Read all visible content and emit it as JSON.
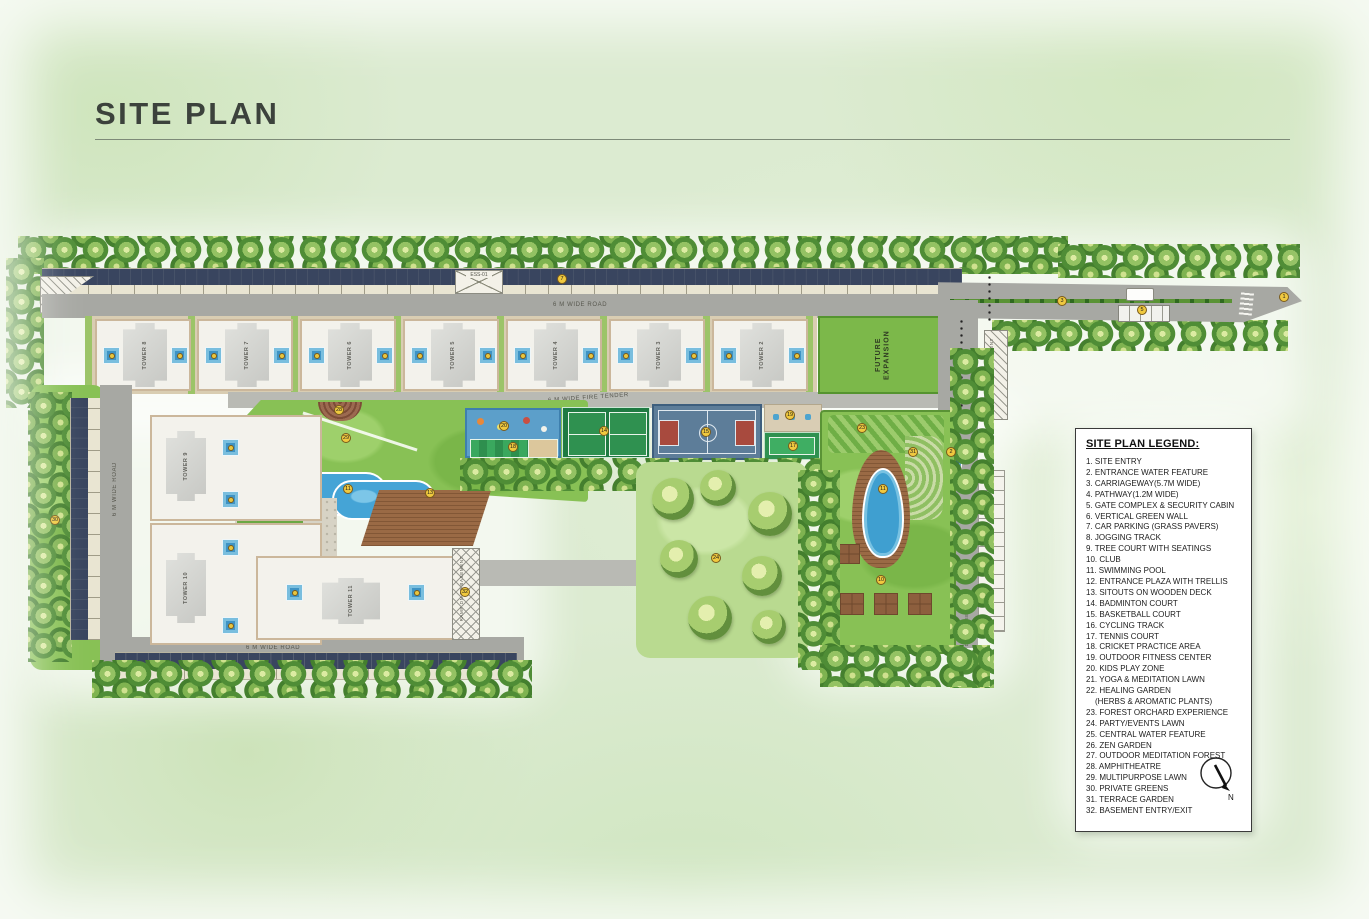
{
  "title": "SITE PLAN",
  "legend": {
    "title": "SITE PLAN LEGEND:",
    "items": [
      "1. SITE ENTRY",
      "2. ENTRANCE WATER FEATURE",
      "3. CARRIAGEWAY(5.7M WIDE)",
      "4. PATHWAY(1.2M WIDE)",
      "5. GATE COMPLEX & SECURITY CABIN",
      "6. VERTICAL GREEN WALL",
      "7. CAR PARKING (GRASS PAVERS)",
      "8. JOGGING TRACK",
      "9. TREE COURT WITH SEATINGS",
      "10. CLUB",
      "11. SWIMMING POOL",
      "12. ENTRANCE PLAZA WITH TRELLIS",
      "13. SITOUTS ON WOODEN DECK",
      "14. BADMINTON COURT",
      "15. BASKETBALL COURT",
      "16. CYCLING TRACK",
      "17. TENNIS COURT",
      "18. CRICKET PRACTICE AREA",
      "19. OUTDOOR FITNESS CENTER",
      "20. KIDS PLAY ZONE",
      "21. YOGA & MEDITATION LAWN",
      "22. HEALING GARDEN",
      "(HERBS & AROMATIC PLANTS)",
      "23. FOREST ORCHARD EXPERIENCE",
      "24. PARTY/EVENTS LAWN",
      "25. CENTRAL WATER FEATURE",
      "26. ZEN GARDEN",
      "27. OUTDOOR MEDITATION FOREST",
      "28. AMPHITHEATRE",
      "29. MULTIPURPOSE LAWN",
      "30. PRIVATE GREENS",
      "31. TERRACE GARDEN",
      "32. BASEMENT ENTRY/EXIT"
    ]
  },
  "plan": {
    "towers_top": [
      "TOWER 8",
      "TOWER 7",
      "TOWER 6",
      "TOWER 5",
      "TOWER 4",
      "TOWER 3",
      "TOWER 2"
    ],
    "towers_left": [
      "TOWER 9",
      "TOWER 10",
      "TOWER 11"
    ],
    "roads": {
      "top": "6 M WIDE ROAD",
      "fire": "6 M WIDE FIRE TENDER",
      "left": "6 M WIDE ROAD",
      "bottom": "6 M WIDE ROAD"
    },
    "future_expansion": "FUTURE EXPANSION",
    "ess": "ESS-01",
    "ramp_right": "RAMP DN TO BASEMENT",
    "ramp_tower11": "RAMP DN TO BASEMENT",
    "ramp_club": "RAMP DN TO BASEMENT",
    "north": "N",
    "markers": [
      {
        "n": "1",
        "x": 1284,
        "y": 297
      },
      {
        "n": "2",
        "x": 951,
        "y": 452
      },
      {
        "n": "3",
        "x": 1062,
        "y": 301
      },
      {
        "n": "5",
        "x": 1142,
        "y": 310
      },
      {
        "n": "7",
        "x": 562,
        "y": 279
      },
      {
        "n": "10",
        "x": 881,
        "y": 580
      },
      {
        "n": "11",
        "x": 348,
        "y": 489
      },
      {
        "n": "11",
        "x": 883,
        "y": 489
      },
      {
        "n": "13",
        "x": 430,
        "y": 493
      },
      {
        "n": "14",
        "x": 604,
        "y": 431
      },
      {
        "n": "15",
        "x": 706,
        "y": 432
      },
      {
        "n": "17",
        "x": 793,
        "y": 446
      },
      {
        "n": "18",
        "x": 513,
        "y": 447
      },
      {
        "n": "19",
        "x": 790,
        "y": 415
      },
      {
        "n": "20",
        "x": 504,
        "y": 426
      },
      {
        "n": "23",
        "x": 862,
        "y": 428
      },
      {
        "n": "24",
        "x": 716,
        "y": 558
      },
      {
        "n": "28",
        "x": 339,
        "y": 410
      },
      {
        "n": "29",
        "x": 346,
        "y": 438
      },
      {
        "n": "30",
        "x": 55,
        "y": 520
      },
      {
        "n": "31",
        "x": 913,
        "y": 452
      },
      {
        "n": "32",
        "x": 465,
        "y": 592
      }
    ]
  },
  "colors": {
    "background": "#dcebd1",
    "road": "#a7a8a3",
    "lawn": "#88c155",
    "pool": "#45a4d6",
    "deck": "#9a6a45",
    "future_expansion": "#7cb84a",
    "basketball": "#5d7d99",
    "court_green": "#2f9150",
    "marker": "#f0c93f",
    "legend_bg": "#ffffff"
  }
}
